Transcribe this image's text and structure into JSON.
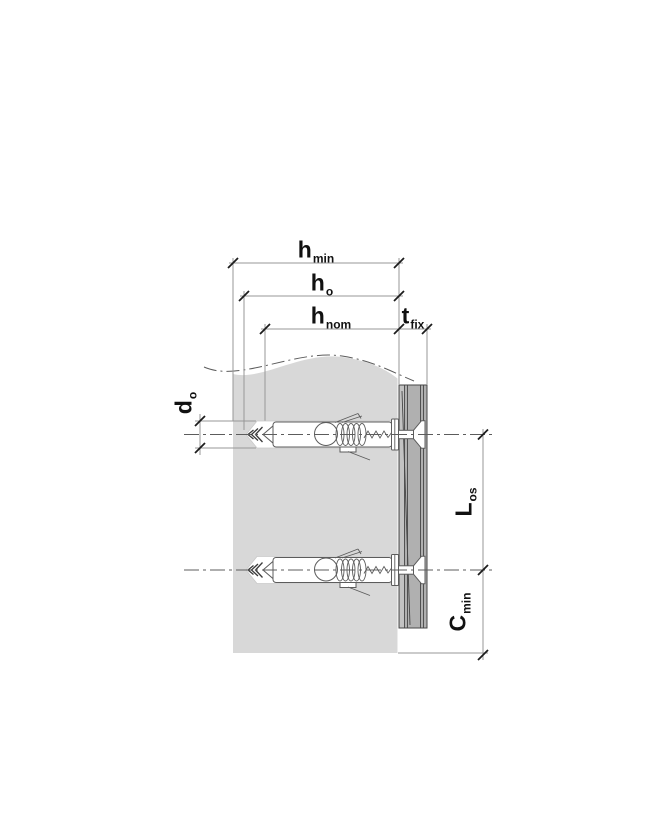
{
  "diagram": {
    "description": "Technical cross-section diagram of two expansion frame anchors with countersunk screws installed through a fixture board into a wall, with installation dimension symbols",
    "labels": {
      "h_min": {
        "main": "h",
        "sub": "min"
      },
      "h_o": {
        "main": "h",
        "sub": "o"
      },
      "h_nom": {
        "main": "h",
        "sub": "nom"
      },
      "t_fix": {
        "main": "t",
        "sub": "fix"
      },
      "d_o": {
        "main": "d",
        "sub": "o"
      },
      "L_os": {
        "main": "L",
        "sub": "os"
      },
      "C_min": {
        "main": "C",
        "sub": "min"
      }
    },
    "colors": {
      "wall": "#d8d8d8",
      "panel": "#b0b0b0",
      "panel_strip": "#c3c3c3",
      "panel_line": "#474747",
      "dim_line": "#979797",
      "tick": "#1c1c1c",
      "outline": "#5c5c5c",
      "label": "#111111",
      "bg": "#ffffff"
    }
  }
}
